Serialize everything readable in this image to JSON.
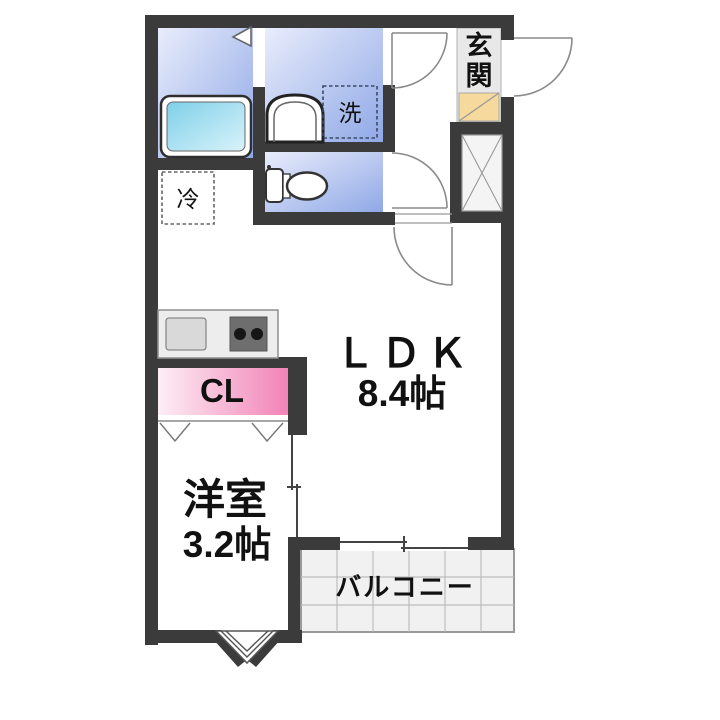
{
  "plan": {
    "rooms": {
      "ldk": {
        "label": "ＬＤＫ",
        "size": "8.4帖"
      },
      "western": {
        "label": "洋室",
        "size": "3.2帖"
      },
      "balcony": {
        "label": "バルコニー"
      },
      "entrance": {
        "label": "玄関",
        "chars": [
          "玄",
          "関"
        ]
      },
      "closet": {
        "label": "CL"
      },
      "laundry": {
        "label": "洗"
      },
      "fridge": {
        "label": "冷"
      }
    },
    "colors": {
      "wall": "#3b3b3b",
      "wet_room_light": "#e7ecfb",
      "wet_room_dark": "#8fa8e6",
      "tub_light": "#d9f3fb",
      "tub_dark": "#7fd0e8",
      "closet_light": "#fdeef5",
      "closet_dark": "#f283b7",
      "entrance_step": "#f6d99c",
      "entrance_floor": "#e8e8e8",
      "balcony_floor": "#f1f1f1",
      "counter_gray": "#ededed"
    }
  }
}
